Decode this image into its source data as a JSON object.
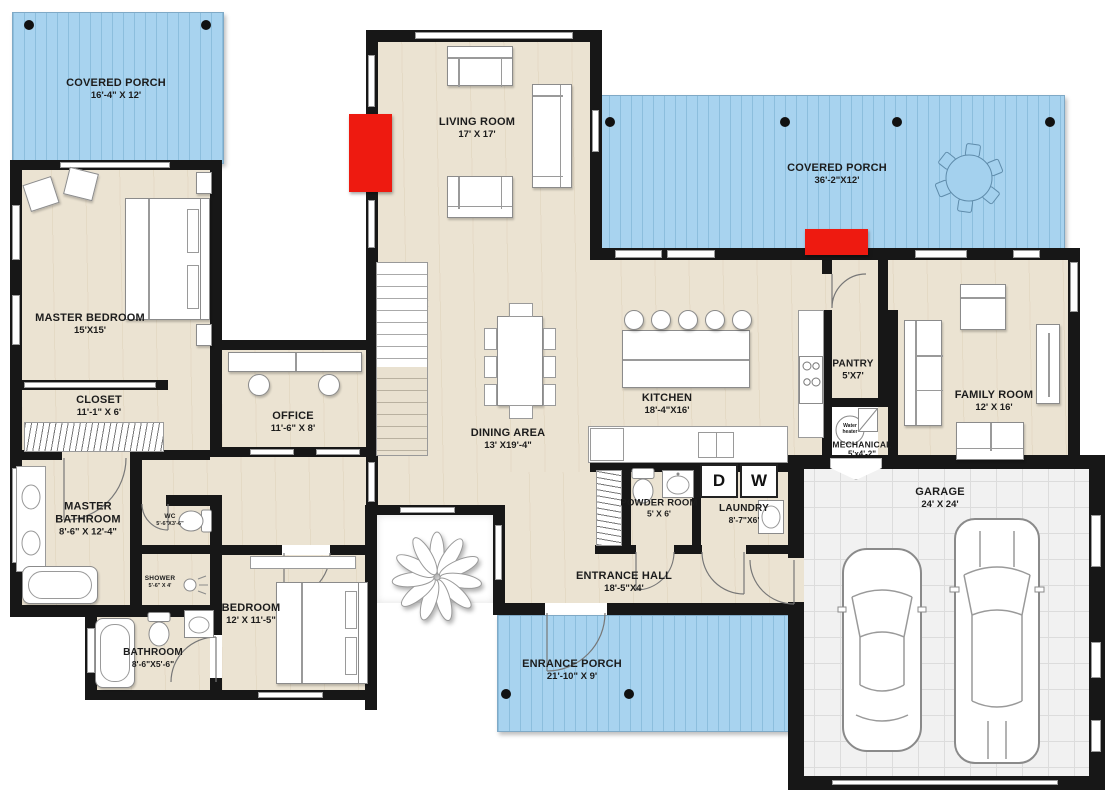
{
  "rooms": {
    "covered_porch_left": {
      "name": "COVERED PORCH",
      "dims": "16'-4\" X 12'"
    },
    "living_room": {
      "name": "LIVING ROOM",
      "dims": "17' X 17'"
    },
    "covered_porch_right": {
      "name": "COVERED PORCH",
      "dims": "36'-2\"X12'"
    },
    "master_bedroom": {
      "name": "MASTER BEDROOM",
      "dims": "15'X15'"
    },
    "closet": {
      "name": "CLOSET",
      "dims": "11'-1\" X 6'"
    },
    "office": {
      "name": "OFFICE",
      "dims": "11'-6\" X 8'"
    },
    "dining_area": {
      "name": "DINING AREA",
      "dims": "13' X19'-4\""
    },
    "kitchen": {
      "name": "KITCHEN",
      "dims": "18'-4\"X16'"
    },
    "pantry": {
      "name": "PANTRY",
      "dims": "5'X7'"
    },
    "mechanical": {
      "name": "MECHANICAL",
      "dims": "5'x4'-2\""
    },
    "family_room": {
      "name": "FAMILY ROOM",
      "dims": "12' X 16'"
    },
    "master_bathroom": {
      "name": "MASTER BATHROOM",
      "dims": "8'-6\" X 12'-4\""
    },
    "wc": {
      "name": "WC",
      "dims": "5'-6\"X3'-6\""
    },
    "shower": {
      "name": "SHOWER",
      "dims": "5'-6\" X 4'"
    },
    "bathroom": {
      "name": "BATHROOM",
      "dims": "8'-6\"X5'-6\""
    },
    "bedroom": {
      "name": "BEDROOM",
      "dims": "12' X 11'-5\""
    },
    "powder_room": {
      "name": "POWDER ROOM",
      "dims": "5' X 6'"
    },
    "laundry": {
      "name": "LAUNDRY",
      "dims": "8'-7\"X6'"
    },
    "entrance_hall": {
      "name": "ENTRANCE HALL",
      "dims": "18'-5\"X4'"
    },
    "entrance_porch": {
      "name": "ENRANCE PORCH",
      "dims": "21'-10\" X 9'"
    },
    "garage": {
      "name": "GARAGE",
      "dims": "24' X 24'"
    }
  },
  "appliances": {
    "dryer": "D",
    "washer": "W",
    "water_heater": "Water heater"
  },
  "colors": {
    "porch": "#a8d3ef",
    "floor": "#ebe3d2",
    "wall": "#171717",
    "accent_red": "#ee1a10",
    "garage_floor": "#f1f1f1"
  }
}
